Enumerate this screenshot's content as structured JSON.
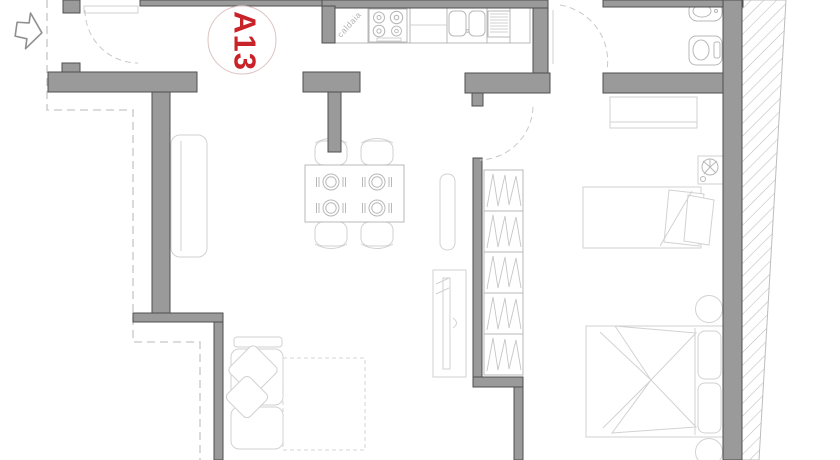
{
  "labels": {
    "unit": "A13",
    "boiler_note": "caldaia"
  },
  "colors": {
    "wall_fill": "#9a9a9a",
    "wall_stroke": "#4f4f4f",
    "accent_red": "#c9232a",
    "furniture_light": "#d2d2d2",
    "furniture_mid": "#b8b8b8",
    "dashed_line": "#c6c6c6",
    "hatch_line": "#bcbcbc",
    "badge_ring": "#dcc3c3",
    "background": "#ffffff"
  }
}
